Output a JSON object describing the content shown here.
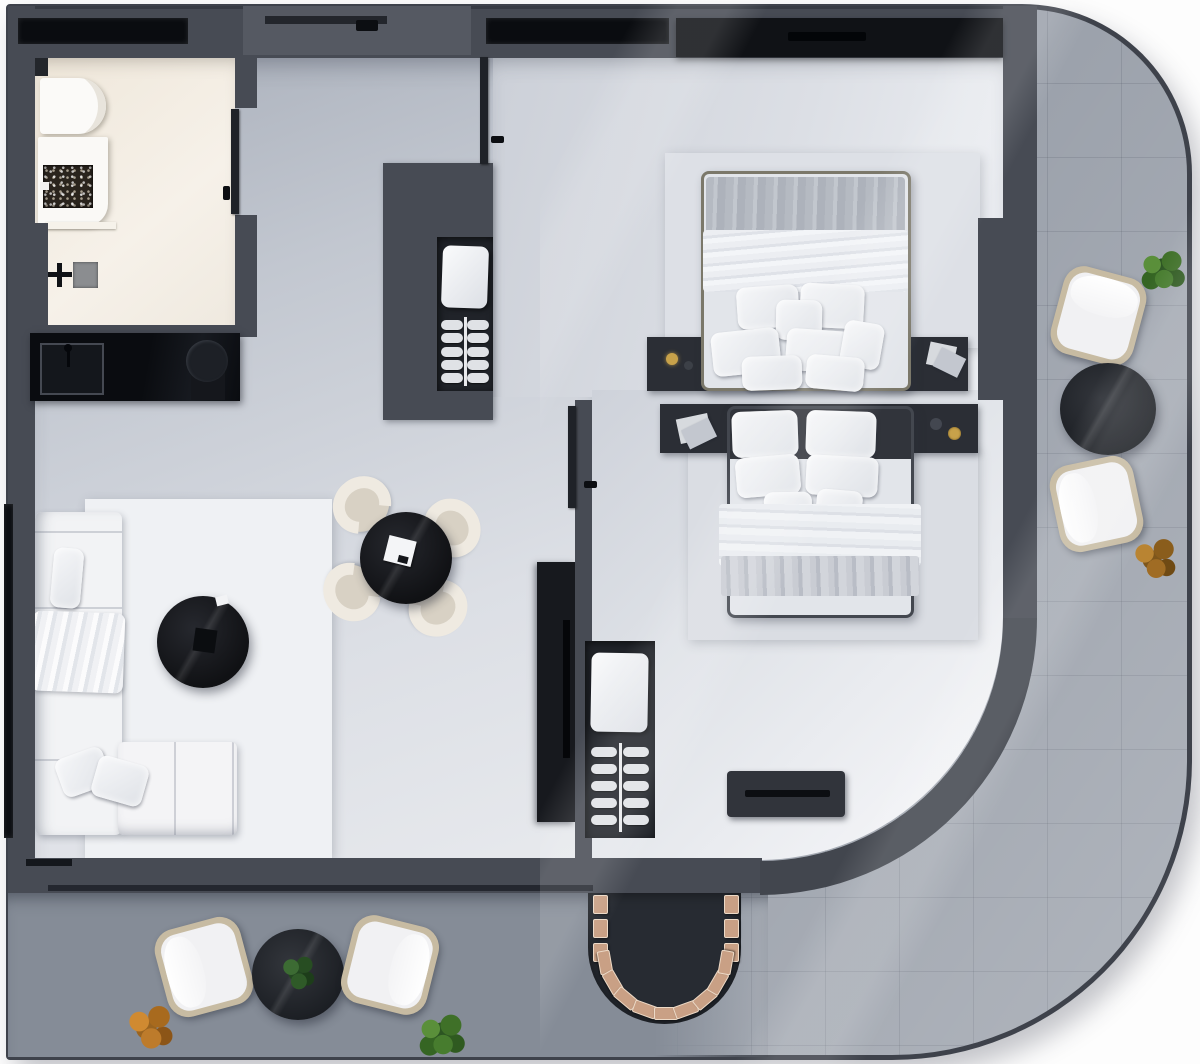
{
  "document": {
    "kind": "apartment-floor-plan-render",
    "view": "top-down",
    "style": "photoreal monochrome gray",
    "visible_text": ""
  },
  "palette": {
    "wall": "#474b54",
    "curvewall": "#42464e",
    "glass": "#0a0c10",
    "terrace": "#9ba1ab",
    "balcony": "#858c97",
    "rug": "#eff1f4",
    "niche": "#202329",
    "headboard": "#2b2e35",
    "ufeature": "#272b32",
    "wood": "#c9a085",
    "wicker": "#c7bba2",
    "cushion": "#f1f1f3",
    "counter_black": "#0c0e12",
    "brass": "#c8a24a"
  },
  "rooms": {
    "bathroom": {
      "name": "bathroom",
      "items": [
        "wall-hung-toilet",
        "cistern-plate",
        "vanity-slab",
        "mosaic-stone-basin",
        "basin-tap",
        "shelf",
        "shower-drain",
        "floor-standing-taps",
        "window"
      ]
    },
    "hallway": {
      "name": "entry-hall",
      "items": [
        "entrance-door",
        "kitchenette-counter",
        "square-sink",
        "gooseneck-faucet",
        "round-basin"
      ]
    },
    "living_room": {
      "name": "living-dining-room",
      "items": [
        "corner-sofa",
        "sofa-pillows",
        "throw-blanket",
        "area-rug",
        "round-coffee-table",
        "tray",
        "card",
        "dining-table",
        "napkin",
        "tv-console",
        "tv"
      ],
      "dining_chair_count": 4
    },
    "bedroom_1": {
      "name": "bedroom-top",
      "items": [
        "double-bed",
        "gray-blanket",
        "sheet-band",
        "headboard-bar",
        "nightstand-left-lamp",
        "nightstand-right-papers",
        "wardrobe",
        "open-closet-niche",
        "window",
        "door"
      ],
      "pillow_count": 8
    },
    "bedroom_2": {
      "name": "bedroom-middle",
      "items": [
        "double-bed",
        "white-blanket",
        "gray-fold",
        "headboard-bar",
        "nightstand-left-papers",
        "nightstand-right-accessories",
        "open-closet-niche",
        "dresser-bench",
        "door",
        "curved-wall"
      ],
      "pillow_count": 7
    },
    "balcony": {
      "name": "balcony-south",
      "items": [
        "wicker-chair",
        "wicker-chair",
        "round-outdoor-table",
        "potted-plant-on-table",
        "orange-plant",
        "green-plant",
        "curved-step-feature"
      ]
    },
    "terrace": {
      "name": "terrace-east",
      "items": [
        "wicker-chair",
        "wicker-chair",
        "round-outdoor-table",
        "green-plant",
        "brown-plant"
      ]
    }
  },
  "closets": {
    "hanger_rows": 5,
    "rail_color": "#e8e9ec"
  },
  "curved_steps": {
    "side_blocks_per_side": 3,
    "arc_blocks": 9,
    "block_color": "#c9a085"
  },
  "counts": {
    "windows": 3,
    "interior_doors": 3,
    "outdoor_chairs": 4,
    "outdoor_tables": 2,
    "plants": 7,
    "beds": 2
  }
}
